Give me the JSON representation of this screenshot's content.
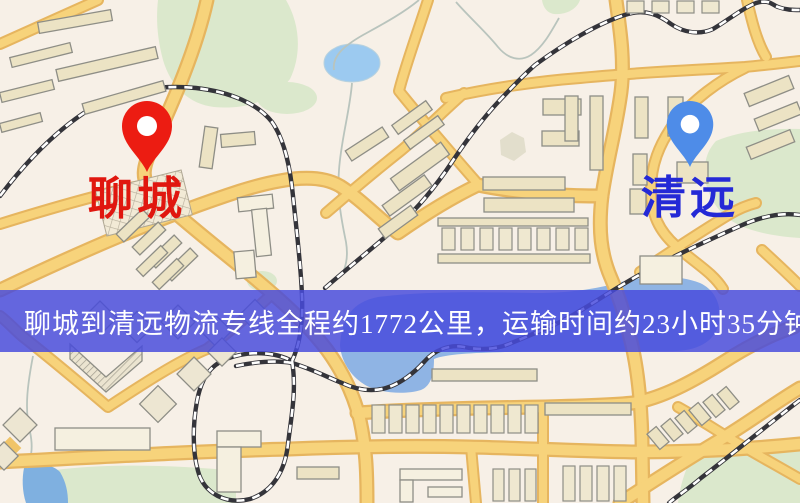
{
  "banner": {
    "text": "聊城到清远物流专线全程约1772公里，运输时间约23小时35分钟.",
    "background_color": "#4a4bdc",
    "text_color": "#ffffff"
  },
  "markers": [
    {
      "id": "origin",
      "label": "聊城",
      "label_color": "#e0170f",
      "pin_color": "#ec1c12"
    },
    {
      "id": "destination",
      "label": "清远",
      "label_color": "#2429d6",
      "pin_color": "#4e8ce8"
    }
  ],
  "route": {
    "origin": "聊城",
    "destination": "清远",
    "distance_text": "约1772公里",
    "duration_text": "约23小时35分钟"
  },
  "map_colors": {
    "background": "#f7f0e7",
    "road_fill": "#f7d37b",
    "road_casing": "#e6b55f",
    "green_area": "#dbe8cc",
    "lake": "#9ccaf0",
    "river": "#8fb4e4",
    "railway": "#34343a",
    "building": "#ece3c4"
  }
}
